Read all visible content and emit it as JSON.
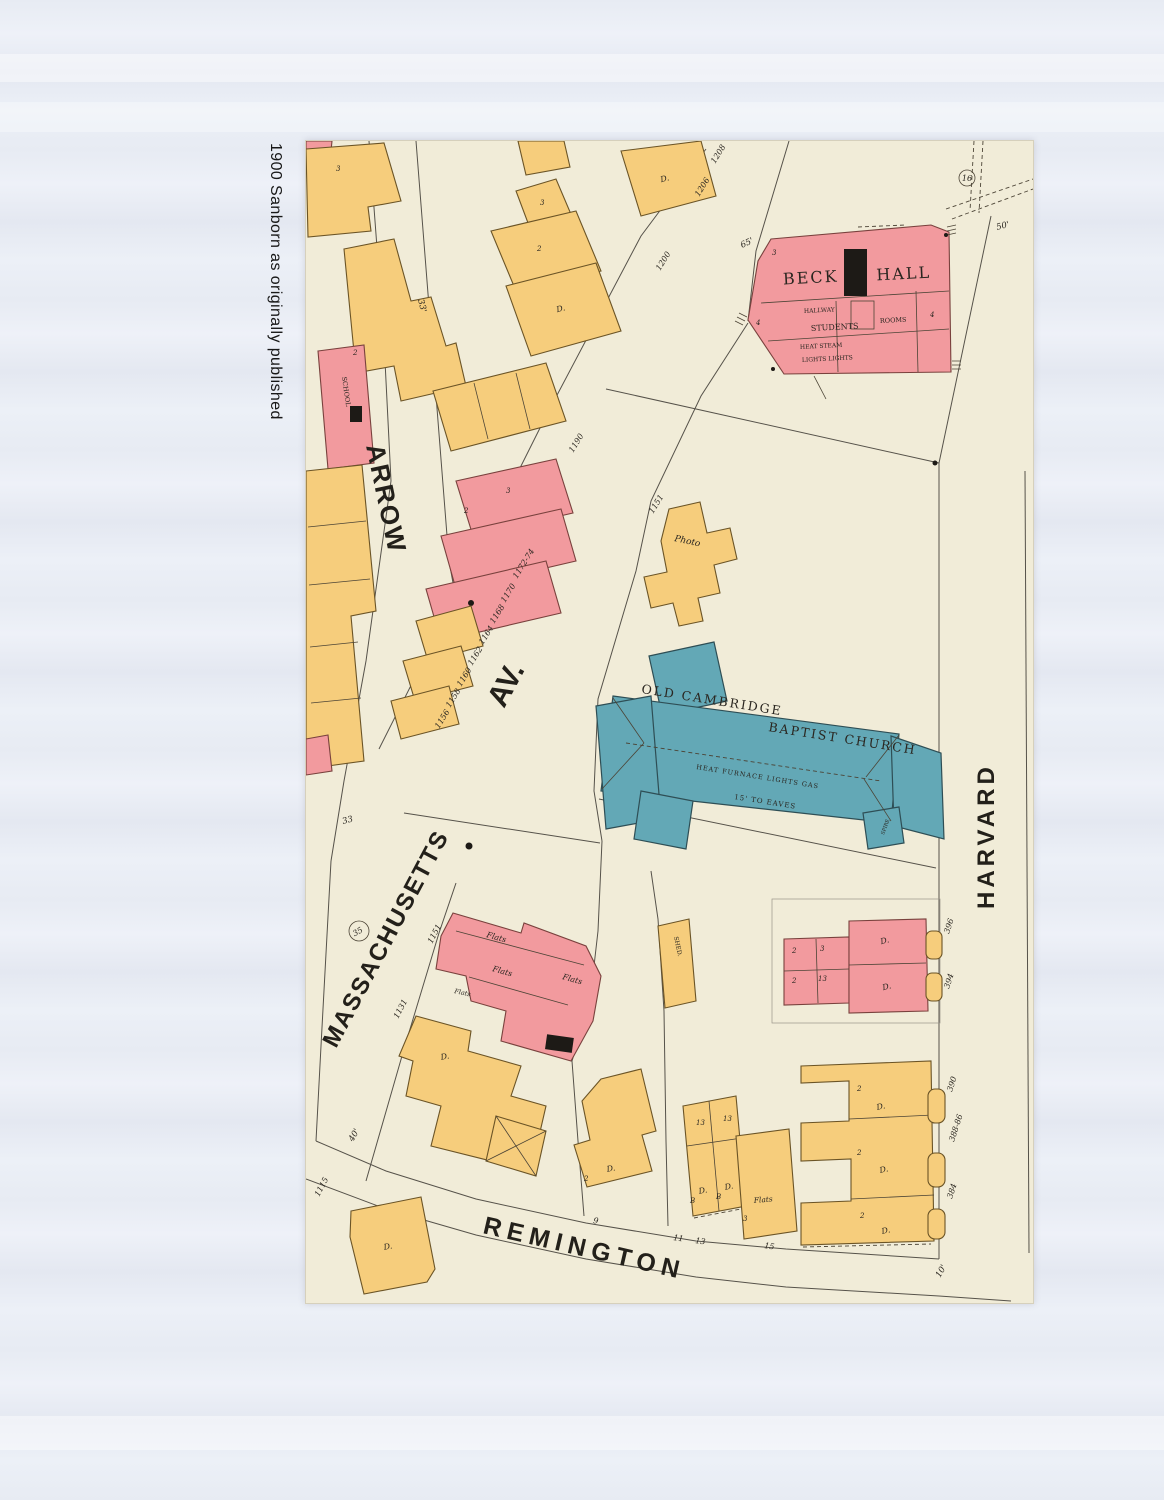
{
  "colors": {
    "page_background": "#e8ecf4",
    "paper": "#f1ecd8",
    "building_yellow": "#f6cd7c",
    "building_pink": "#f29a9e",
    "building_teal": "#63a8b6"
  },
  "caption": "1900 Sanborn as originally published",
  "streets": {
    "arrow": "ARROW",
    "av": "AV.",
    "massachusetts": "MASSACHUSETTS",
    "harvard": "HARVARD",
    "remington": "REMINGTON"
  },
  "beck_hall": {
    "name_left": "BECK",
    "name_right": "HALL",
    "hallway": "HALLWAY",
    "students": "STUDENTS",
    "rooms": "ROOMS",
    "heat": "HEAT STEAM",
    "lights": "LIGHTS LIGHTS",
    "lot_a": "3",
    "lot_b": "4",
    "lot_c": "4"
  },
  "church": {
    "name_line1": "OLD CAMBRIDGE",
    "name_line2": "BAPTIST CHURCH",
    "heat": "HEAT FURNACE LIGHTS GAS",
    "eaves": "15' TO EAVES",
    "spire": "SPIRE"
  },
  "labels": {
    "photo": "Photo",
    "shed": "SHED.",
    "school": "SCHOOL",
    "flats": "Flats",
    "dwelling": "D.",
    "basement": "B"
  },
  "house_numbers": {
    "mass_ave_upper": [
      "1156",
      "1158",
      "1160",
      "1162",
      "1164",
      "1168",
      "1170",
      "1172-74",
      "1190",
      "1200",
      "1206",
      "1208"
    ],
    "mass_ave_lower": [
      "1151",
      "1131",
      "1115"
    ],
    "photo_lot": "1151",
    "harvard": [
      "396",
      "394",
      "390",
      "388-86",
      "384"
    ],
    "remington": [
      "9",
      "11",
      "13",
      "15"
    ]
  },
  "unit_numbers": {
    "one": "1",
    "two": "2",
    "three": "3",
    "thirteen": "13"
  },
  "dimensions": {
    "d33": "33'",
    "d33b": "33",
    "d65": "65'",
    "d50": "50'",
    "d40": "40'",
    "d10": "10'"
  },
  "markers": {
    "block_number": "35",
    "corner_number": "16"
  }
}
